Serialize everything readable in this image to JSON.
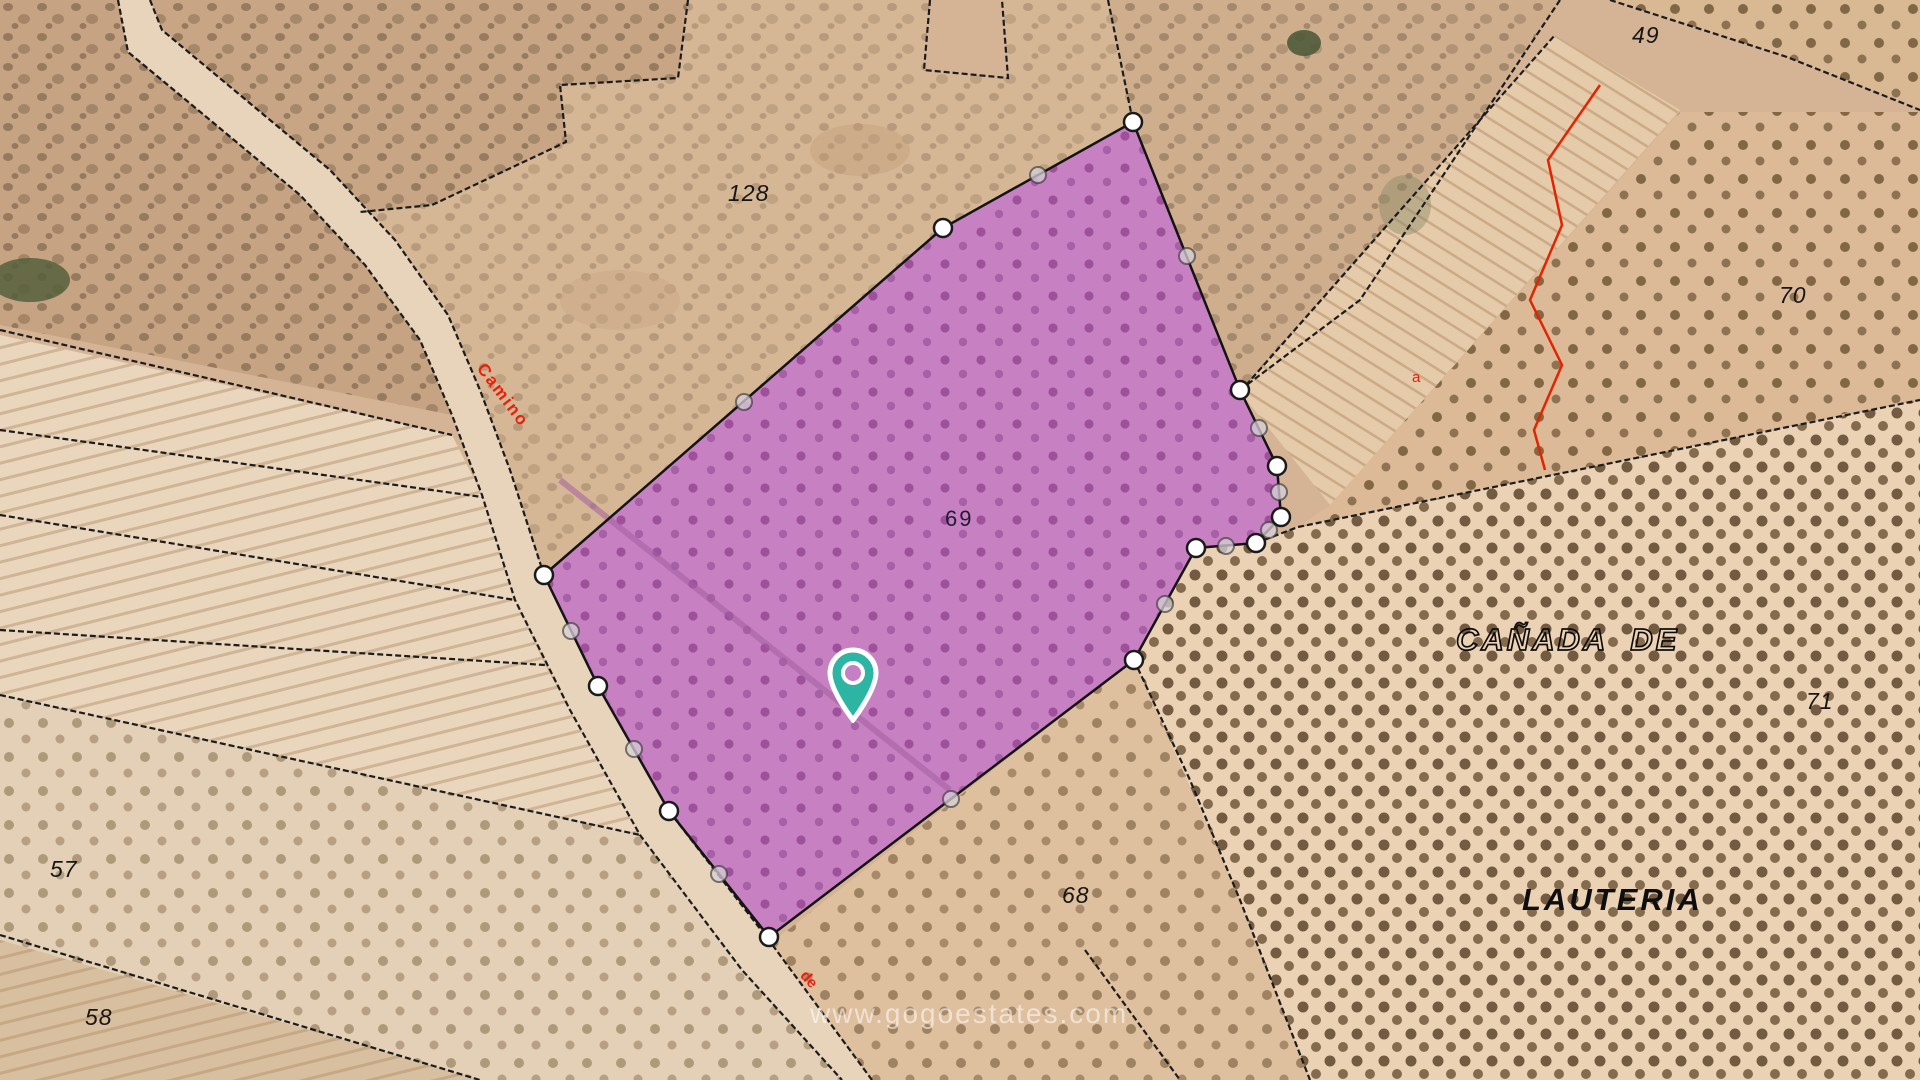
{
  "map": {
    "watermark": "www.gogoestates.com",
    "parcel_numbers": {
      "p128": "128",
      "p69": "69",
      "p68": "68",
      "p49": "49",
      "p70": "70",
      "p71": "71",
      "p57": "57",
      "p58": "58"
    },
    "place_names": {
      "canada_de": "CAÑADA  DE",
      "lauteria": "LAUTERIA"
    },
    "road_names": {
      "camino": "Camino",
      "de": "de",
      "a": "a"
    },
    "selected_parcel": {
      "number": "69",
      "fill_color": "#c67cc6",
      "tree_dot_color": "#9a4a96"
    },
    "pin_color": "#2cb5a2",
    "boundary_red_color": "#e32400",
    "cadastral_line_color": "#1c1c1c"
  }
}
